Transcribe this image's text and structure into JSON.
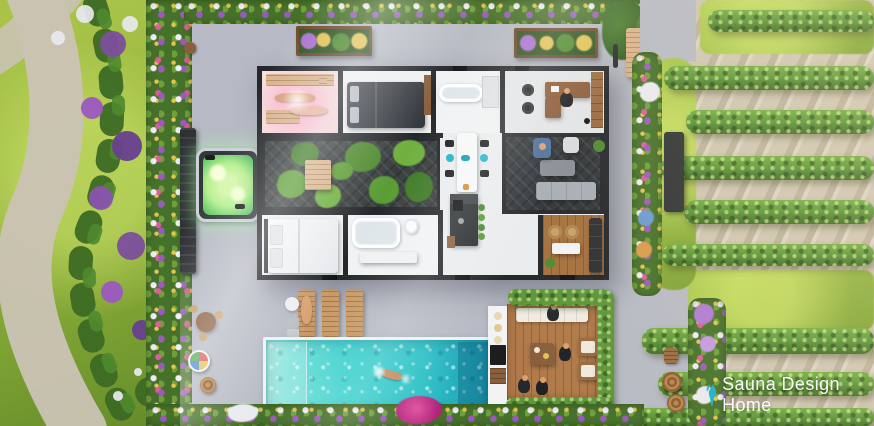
{
  "watermark": {
    "text": "Sauna Design Home",
    "icon": "sauna-steam-logo-icon"
  },
  "scene": {
    "type": "aerial-3d-render",
    "description": "Top-down 3D architectural rendering of a modern flat-roof villa (roof removed) with interior courtyard garden, sauna room, two bedrooms, two bathrooms, office, kitchen-dining, living room, outdoor hot tub, swimming pool with swimmer, sun loungers, timber dining deck, lawn with winding path, flower borders and rows of hedges",
    "elements": [
      "left-lawn",
      "garden-path",
      "shrub-line",
      "purple-flower-bushes",
      "flower-border-left",
      "privacy-fence",
      "hot-tub",
      "patio-concrete",
      "planter-box",
      "top-flower-hedge",
      "trees",
      "garden-bench",
      "bicycle",
      "house",
      "sauna-room",
      "bedroom-top",
      "bathroom-top",
      "office",
      "courtyard-garden",
      "dining-area",
      "kitchen-island",
      "living-room",
      "bedroom-bottom",
      "bathroom-bottom",
      "lounge-room",
      "swimming-pool",
      "swimmer",
      "sun-loungers",
      "outdoor-bar-counter",
      "outdoor-deck",
      "deck-hedge",
      "right-garden",
      "hedge-rows",
      "flower-border-right",
      "bottom-flower-border",
      "barrels",
      "round-table-set",
      "parasol"
    ]
  },
  "colors": {
    "patio": "#b7bac4",
    "patioLight": "#dcdde2",
    "lawn": "#93b53e",
    "lawnDark": "#6e9230",
    "path": "#cac3b3",
    "hedge": "#5d9638",
    "hedgeDark": "#3e6b22",
    "gravel": "#cfc6b2",
    "pool": "#3ed2cf",
    "poolDeep": "#1f9cb4",
    "poolShallow": "#8fe6dd",
    "wall": "#24272b",
    "floor": "#eceef0",
    "deckDark": "#383d3d",
    "wood": "#b07a4a",
    "woodLight": "#d9b48e",
    "furnitureDark": "#2c2f33",
    "sofaGray": "#a7aeb6",
    "accentTeal": "#18b7c9",
    "saunaPink": "#ff9fc4",
    "hotTubGlow": "#b5ef8e",
    "flowerPurple": "#9b59c0",
    "flowerPink": "#e05a9e",
    "flowerWhite": "#f0eef6",
    "flowerYellow": "#e3c44f",
    "skin": "#d9a070",
    "watermarkCyan": "#2ab5cc",
    "watermarkText": "#ffffff"
  }
}
